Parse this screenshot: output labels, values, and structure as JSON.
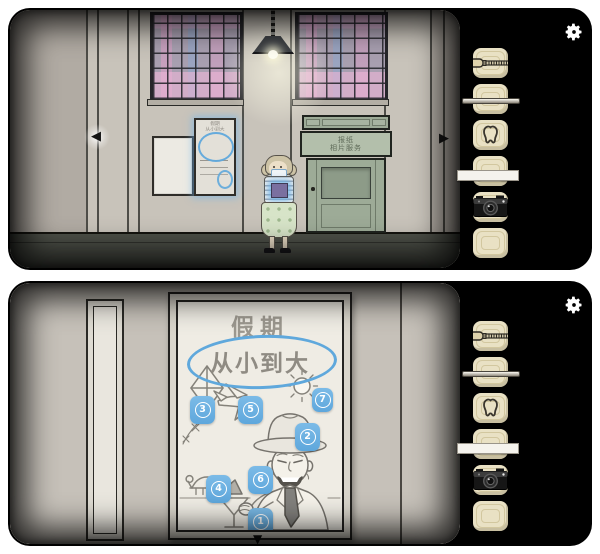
{
  "settings": {
    "label": "settings"
  },
  "nav": {
    "left_arrow": "◀",
    "right_arrow": "▶",
    "down_arrow": "▼"
  },
  "street_scene": {
    "shop_sign": {
      "line1": "报纸",
      "line2": "相片服务"
    },
    "wall_hint_poster": {
      "title": "假期",
      "subtitle": "从小到大"
    }
  },
  "poster_view": {
    "title": "假期",
    "circled_text": "从小到大",
    "tags": [
      {
        "label": "1",
        "item": "cocktail-glass"
      },
      {
        "label": "2",
        "item": "hat"
      },
      {
        "label": "3",
        "item": "kite"
      },
      {
        "label": "4",
        "item": "turtle"
      },
      {
        "label": "5",
        "item": "airplane"
      },
      {
        "label": "6",
        "item": "paper-boat"
      },
      {
        "label": "7",
        "item": "sun"
      }
    ]
  },
  "inventory": {
    "items": [
      "screwdriver",
      "thin-rod",
      "tooth",
      "paper-strip",
      "camera",
      "empty"
    ]
  },
  "colors": {
    "tag_blue": "#6cb1e1",
    "highlight_blue": "#5fa8dc",
    "slot_beige": "#e9e1c4",
    "door_green": "#9dab97"
  }
}
